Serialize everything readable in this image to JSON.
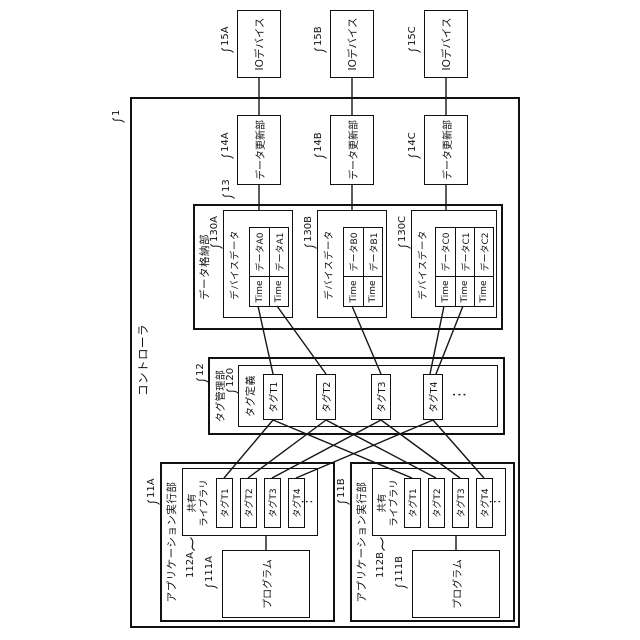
{
  "diagram": {
    "controller": {
      "ref": "1",
      "title": "コントローラ"
    },
    "io_devices": [
      {
        "ref": "15A",
        "label": "IOデバイス"
      },
      {
        "ref": "15B",
        "label": "IOデバイス"
      },
      {
        "ref": "15C",
        "label": "IOデバイス"
      }
    ],
    "updaters": [
      {
        "ref": "14A",
        "label": "データ更新部"
      },
      {
        "ref": "14B",
        "label": "データ更新部"
      },
      {
        "ref": "14C",
        "label": "データ更新部"
      }
    ],
    "storage": {
      "ref": "13",
      "title": "データ格納部",
      "devices": [
        {
          "ref": "130A",
          "title": "デバイスデータ",
          "records": [
            {
              "time": "Time",
              "value": "データA0"
            },
            {
              "time": "Time",
              "value": "データA1"
            }
          ]
        },
        {
          "ref": "130B",
          "title": "デバイスデータ",
          "records": [
            {
              "time": "Time",
              "value": "データB0"
            },
            {
              "time": "Time",
              "value": "データB1"
            }
          ]
        },
        {
          "ref": "130C",
          "title": "デバイスデータ",
          "records": [
            {
              "time": "Time",
              "value": "データC0"
            },
            {
              "time": "Time",
              "value": "データC1"
            },
            {
              "time": "Time",
              "value": "データC2"
            }
          ]
        }
      ]
    },
    "tag_manager": {
      "ref": "12",
      "title": "タグ管理部",
      "definition": {
        "ref": "120",
        "title": "タグ定義",
        "tags": [
          "タグT1",
          "タグT2",
          "タグT3",
          "タグT4"
        ],
        "ellipsis": "⋮"
      }
    },
    "executors": [
      {
        "ref": "11A",
        "title": "アプリケーション実行部",
        "library": {
          "ref": "112A",
          "name_line1": "共有",
          "name_line2": "ライブラリ",
          "tags": [
            "タグT1",
            "タグT2",
            "タグT3",
            "タグT4"
          ],
          "ellipsis": "⋮"
        },
        "program": {
          "ref": "111A",
          "label": "プログラム"
        }
      },
      {
        "ref": "11B",
        "title": "アプリケーション実行部",
        "library": {
          "ref": "112B",
          "name_line1": "共有",
          "name_line2": "ライブラリ",
          "tags": [
            "タグT1",
            "タグT2",
            "タグT3",
            "タグT4"
          ],
          "ellipsis": "⋮"
        },
        "program": {
          "ref": "111B",
          "label": "プログラム"
        }
      }
    ]
  }
}
